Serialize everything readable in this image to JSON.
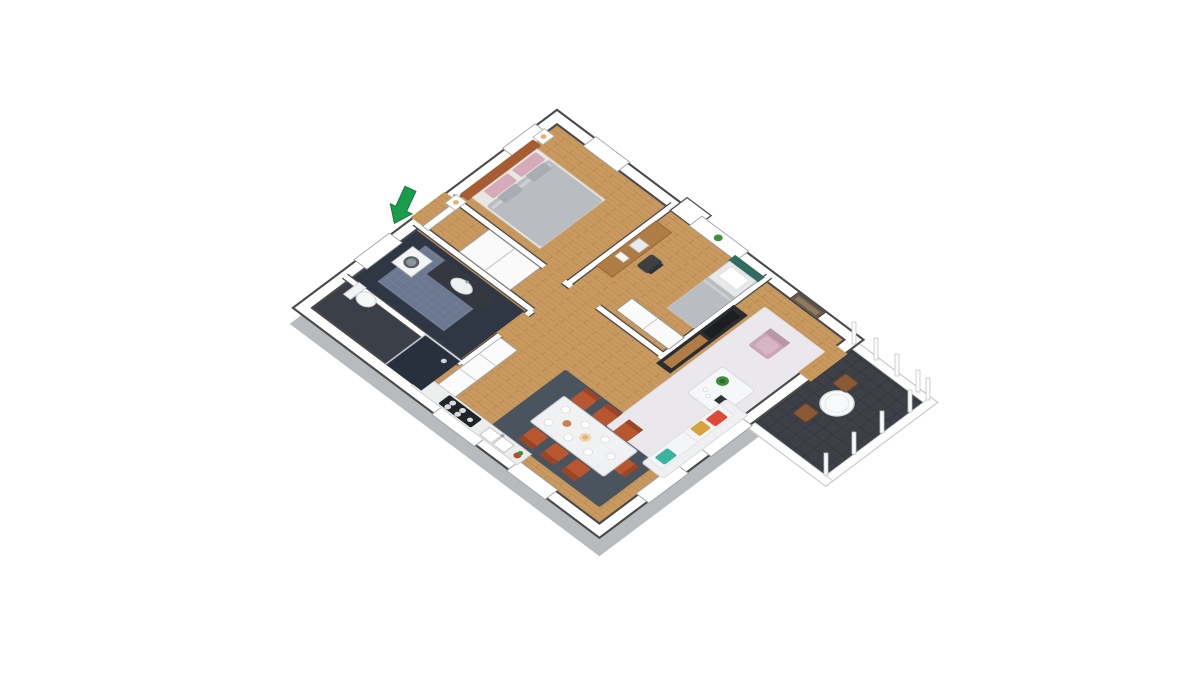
{
  "scene": {
    "kind": "3d-floor-plan-render",
    "description": "Isometric 3D floor plan of a two-bedroom apartment on a white background, entrance marked with a green arrow at the upper left",
    "background": "#ffffff",
    "view": "rotated top-down isometric, diamond orientation"
  },
  "colors": {
    "wall_white": "#ffffff",
    "wall_outline": "#4a4a4a",
    "plinth_gray": "#ced2d5",
    "plinth_edge": "#b7bbbe",
    "wood_floor": "#c99a5f",
    "wood_line": "#b5834a",
    "bathroom_tile_dark": "#2f3745",
    "bathroom_tile_light": "#6b7890",
    "balcony_tile": "#3d4147",
    "balcony_tile_line": "#2c2f33",
    "living_rug": "#eae8ed",
    "dining_rug": "#4a545e",
    "arrow_green": "#1a9c4b",
    "arrow_green_dark": "#0f7d3c",
    "headboard_sienna": "#a85c33",
    "duvet_gray": "#b9bdc1",
    "pillow_pink": "#d6abb9",
    "pillow_gray": "#a7adb3",
    "bed_teal": "#2f6d62",
    "sofa_white": "#eef0f2",
    "pillow_red": "#dd4a3a",
    "pillow_yellow": "#d9a23c",
    "pillow_teal": "#3ab3a1",
    "armchair_pink": "#c9a6b4",
    "armchair_pink_light": "#d7b6c4",
    "chair_rust": "#b8572f",
    "chair_rust_dark": "#9c4526",
    "tv_unit_dark": "#2b2d31",
    "desk_wood": "#b07c46",
    "marble_table": "#eff1f2",
    "counter_gray": "#eceeed",
    "cooktop_black": "#222528",
    "cabinet_white": "#fbfbfb",
    "plant_green": "#3f8f3d",
    "lamp_amber": "#e8b06a",
    "balcony_chair_brown": "#8a5a36",
    "shower_tile": "#28303d",
    "vanity_dark": "#35393f"
  },
  "rooms": [
    {
      "name": "master-bedroom",
      "position": "north-west",
      "furniture": [
        "double-bed",
        "headboard",
        "two-nightstands",
        "lamps",
        "pink-and-gray-pillows"
      ]
    },
    {
      "name": "second-bedroom",
      "position": "north-east",
      "furniture": [
        "single-bed",
        "desk",
        "desk-chair",
        "laptop",
        "wardrobe"
      ]
    },
    {
      "name": "living-room",
      "position": "east",
      "furniture": [
        "white-rug",
        "sofa-with-pillows",
        "pink-armchair",
        "coffee-table-with-plant",
        "tv-sideboard",
        "wall-picture"
      ]
    },
    {
      "name": "dining-area",
      "position": "south-center",
      "furniture": [
        "marble-dining-table",
        "seven-rust-chairs",
        "dark-rug",
        "candle"
      ]
    },
    {
      "name": "kitchen",
      "position": "south-west",
      "furniture": [
        "counter-run",
        "cooktop",
        "double-sink",
        "tall-cabinets",
        "flower-pot"
      ]
    },
    {
      "name": "bathroom",
      "position": "west",
      "furniture": [
        "washing-machine",
        "vanity-with-sink",
        "toilet",
        "shower"
      ]
    },
    {
      "name": "hallway-entry",
      "position": "west-center",
      "furniture": [
        "closet",
        "open-door"
      ]
    },
    {
      "name": "balcony",
      "position": "far-east",
      "furniture": [
        "round-table",
        "two-wooden-chairs",
        "railing-posts",
        "dark-tile-floor"
      ]
    }
  ],
  "entrance": {
    "marker": "green-block-arrow",
    "direction": "pointing down-left toward entry door"
  }
}
